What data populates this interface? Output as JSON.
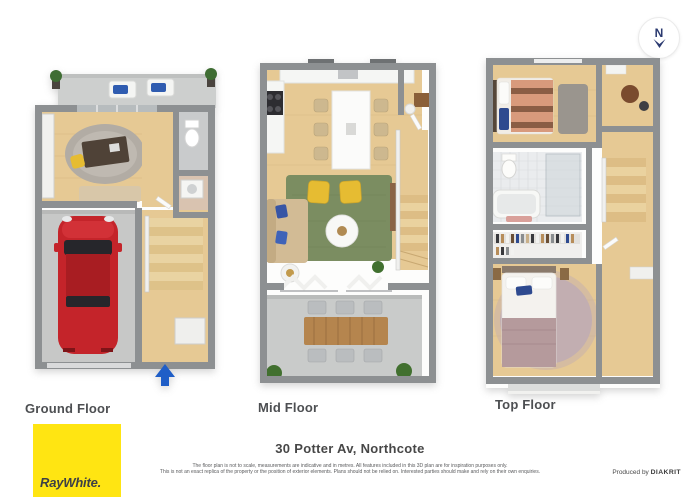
{
  "page": {
    "width": 700,
    "height": 500,
    "background": "#ffffff"
  },
  "compass": {
    "letter": "N",
    "color": "#2b3a70"
  },
  "floors": [
    {
      "id": "ground",
      "label": "Ground Floor"
    },
    {
      "id": "mid",
      "label": "Mid Floor"
    },
    {
      "id": "top",
      "label": "Top Floor"
    }
  ],
  "footer": {
    "address": "30 Potter Av, Northcote",
    "disclaimer_line1": "The floor plan is not to scale, measurements are indicative and in metres. All features included in this 3D plan are for inspiration purposes only.",
    "disclaimer_line2": "This is not an exact replica of the property or the position of exterior elements. Plans should not be relied on. Interested parties should make and rely on their own enquiries.",
    "produced_by": "Produced by",
    "producer": "DIAKRIT"
  },
  "logo": {
    "brand": "RayWhite.",
    "background": "#ffe512",
    "text_color": "#3d4046"
  },
  "palette": {
    "wall_gray": "#8d9092",
    "wood_floor": "#e6c994",
    "concrete": "#c9cbca",
    "patio_slab": "#cdcfce",
    "living_rug_green": "#7b8d61",
    "armchair_yellow": "#e6bc32",
    "car_red": "#c4242a",
    "entry_arrow_blue": "#1f5ec7",
    "fluffy_rug_mauve": "#c2aeb1",
    "duvet_salmon": "#d89a7c",
    "pillow_blue": "#2e4a8f"
  }
}
